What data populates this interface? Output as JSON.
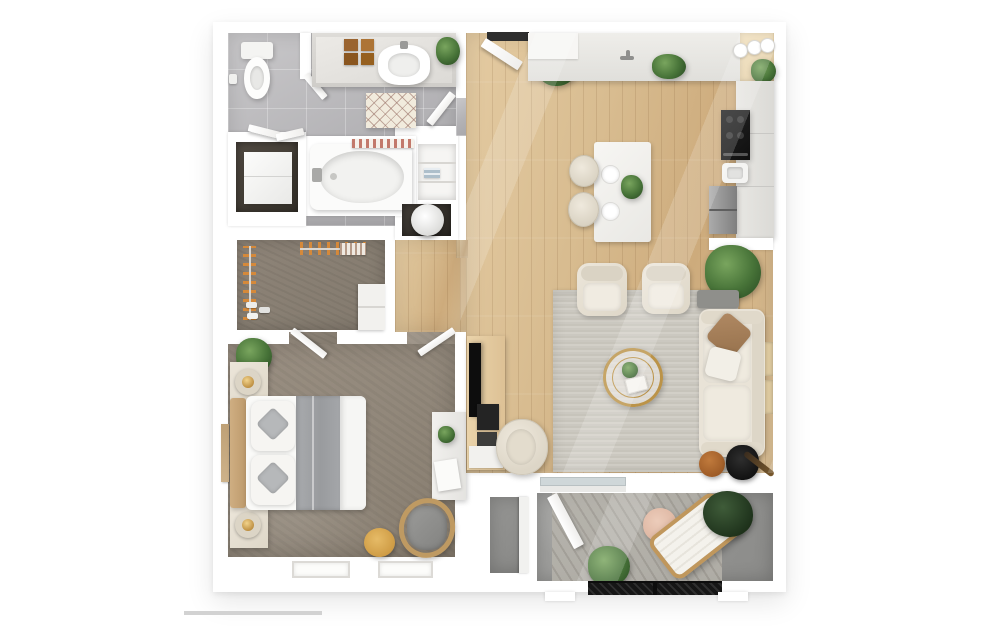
{
  "scene": {
    "label": "One-bedroom apartment top-down 3D floor plan",
    "has_scale_bar": true
  },
  "colors": {
    "wall": "#ffffff",
    "wood_floor": "#d7ba8e",
    "tile_floor": "#b7b6b8",
    "bedroom_carpet": "#968b7e",
    "closet_carpet": "#8a8177",
    "area_rug": "#cdcac2",
    "balcony_concrete": "#9b9b99",
    "sofa_cream": "#e9e3d7",
    "accent_gold": "#bb9348",
    "plant_green": "#477338",
    "wood_furniture": "#c59a5f",
    "appliance_black": "#161616",
    "appliance_steel": "#979797"
  },
  "rooms": [
    {
      "name": "bathroom",
      "items": [
        "toilet",
        "vanity with sink",
        "wooden organizers",
        "plant",
        "diamond bath mat",
        "bathtub",
        "shower curtain"
      ]
    },
    {
      "name": "laundry-closet",
      "items": [
        "washer unit"
      ]
    },
    {
      "name": "linen-closet",
      "items": [
        "shelves",
        "towels"
      ]
    },
    {
      "name": "utility-closet",
      "items": [
        "water heater"
      ]
    },
    {
      "name": "walk-in-closet",
      "items": [
        "hanging rail left",
        "hanging rail top",
        "shoes",
        "shelf unit"
      ]
    },
    {
      "name": "bedroom",
      "items": [
        "bed with gray runner",
        "headboard",
        "pillows",
        "nightstand with lamp (top)",
        "nightstand with lamp (bottom)",
        "potted plant",
        "wall art",
        "desk",
        "papers",
        "lounge chair",
        "wood stool",
        "two windows"
      ]
    },
    {
      "name": "entry",
      "items": [
        "entry door",
        "potted plant"
      ]
    },
    {
      "name": "kitchen",
      "items": [
        "top counter with faucet",
        "counter plant",
        "corner shelf with plates",
        "tall cabinets",
        "black range",
        "small sink",
        "refrigerator",
        "kitchen island",
        "two place settings",
        "island plant",
        "two bar stools",
        "planter with plant"
      ]
    },
    {
      "name": "living-room",
      "items": [
        "media console",
        "tv",
        "av equipment",
        "swivel chair",
        "armchair left",
        "armchair right",
        "area rug",
        "gold round coffee table",
        "coffee table plant",
        "sofa",
        "brown throw pillow",
        "white throw pillow",
        "side table",
        "record player with guitar",
        "potted plant",
        "window trims"
      ]
    },
    {
      "name": "balcony",
      "items": [
        "storage closet",
        "open door",
        "wood deck",
        "round side table",
        "lounge chair",
        "dark plant",
        "green plant",
        "railing"
      ]
    }
  ]
}
